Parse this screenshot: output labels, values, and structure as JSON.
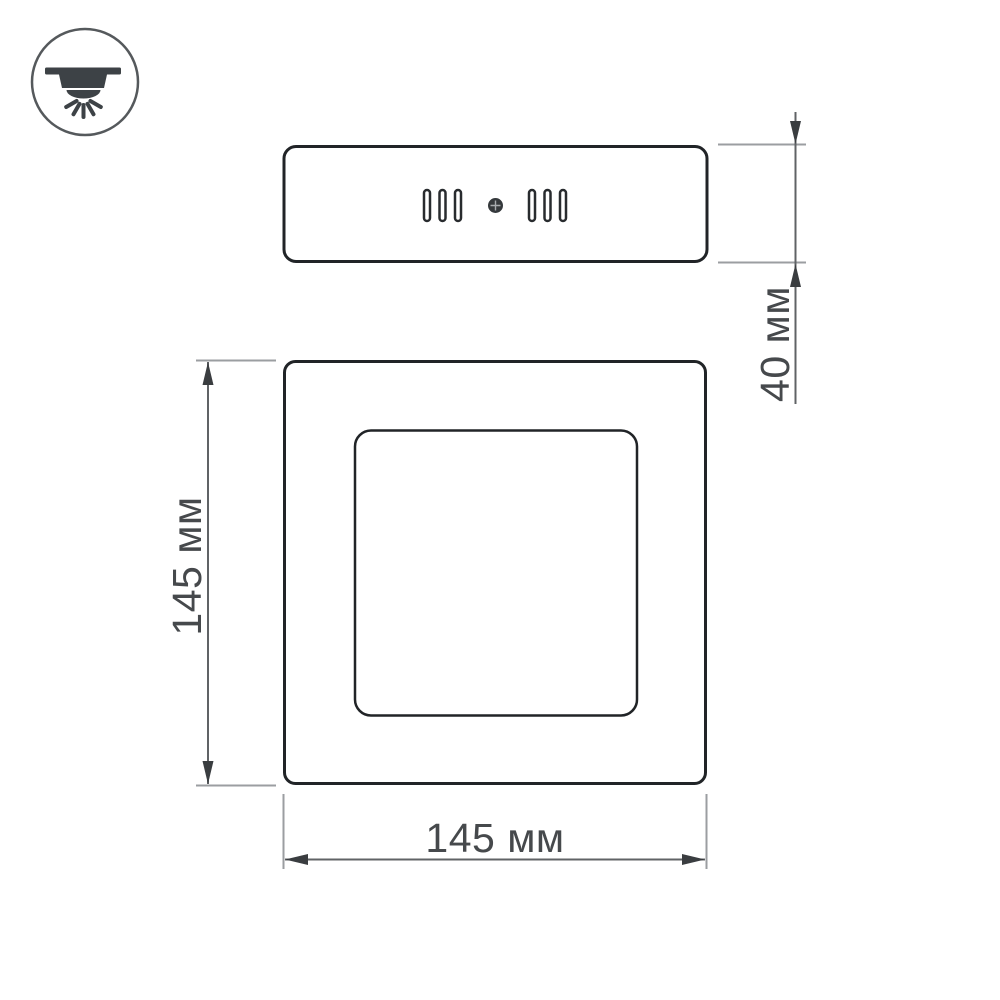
{
  "icon": {
    "name": "ceiling-downlight-icon",
    "rays": 5
  },
  "side_view": {
    "vent_groups": 2,
    "slots_per_group": 3,
    "has_center_screw": true
  },
  "front_view": {
    "outer_shape": "rounded-square",
    "inner_shape": "rounded-square"
  },
  "dimensions": {
    "depth": {
      "label": "40 мм",
      "value_mm": 40,
      "unit": "мм"
    },
    "height": {
      "label": "145 мм",
      "value_mm": 145,
      "unit": "мм"
    },
    "width": {
      "label": "145 мм",
      "value_mm": 145,
      "unit": "мм"
    }
  },
  "colors": {
    "background": "#ffffff",
    "outline": "#212427",
    "slot": "#282b2e",
    "screw": "#35393c",
    "dim_line": "#606366",
    "extension_line": "#9b9ea1",
    "arrow": "#3a3d40",
    "label": "#46494c",
    "icon_stroke": "#55595c",
    "icon_fill": "#3d4246"
  }
}
